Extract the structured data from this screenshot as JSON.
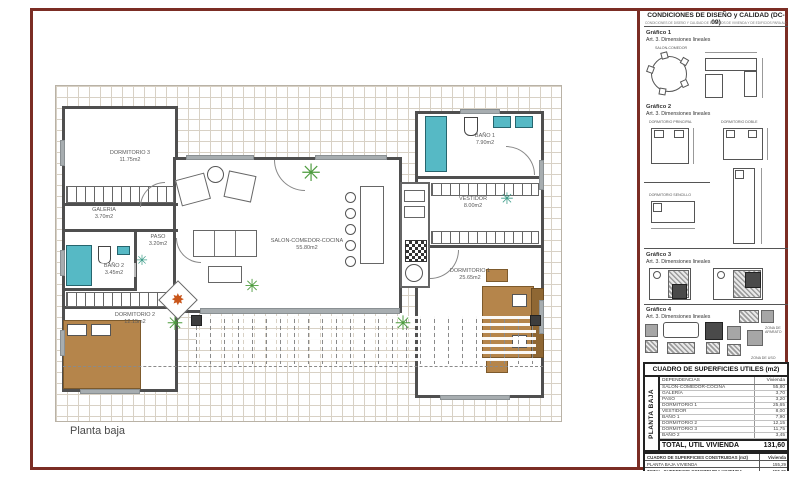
{
  "icons": {
    "plant": "✳",
    "compass_star": "✸"
  },
  "colors": {
    "frame": "#7b2d24",
    "wall": "#4f4f4f",
    "fixture_teal": "#56b9c5",
    "wood_tan": "#b5854b",
    "plant_green": "#4e9c3f",
    "accent_orange": "#c9561b"
  },
  "plan": {
    "floor_label": "Planta baja",
    "rooms": [
      {
        "name": "DORMITORIO 3",
        "area": "11.75m2"
      },
      {
        "name": "GALERIA",
        "area": "3.70m2"
      },
      {
        "name": "PASO",
        "area": "3.20m2"
      },
      {
        "name": "BAÑO 2",
        "area": "3.45m2"
      },
      {
        "name": "DORMITORIO 2",
        "area": "12.15m2"
      },
      {
        "name": "SALON-COMEDOR-COCINA",
        "area": "55.80m2"
      },
      {
        "name": "BAÑO 1",
        "area": "7.90m2"
      },
      {
        "name": "VESTIDOR",
        "area": "8.00m2"
      },
      {
        "name": "DORMITORIO 1",
        "area": "25.65m2"
      }
    ]
  },
  "panel": {
    "title": "CONDICIONES DE DISEÑO y CALIDAD (DC-09)",
    "subtitle": "CONDICIONES DE DISEÑO Y CALIDAD DE EDIFICIOS DE VIVIENDA Y DE EDIFICIOS PARA ALOJAMIENTO",
    "graficos": [
      {
        "label": "Gráfico 1",
        "art": "Art. 3. Dimensiones lineales",
        "caption": "SALON-COMEDOR"
      },
      {
        "label": "Gráfico 2",
        "art": "Art. 3. Dimensiones lineales",
        "caption_a": "DORMITORIO PRINCIPAL",
        "caption_b": "DORMITORIO DOBLE",
        "caption_c": "DORMITORIO SENCILLO"
      },
      {
        "label": "Gráfico 3",
        "art": "Art. 3. Dimensiones lineales"
      },
      {
        "label": "Gráfico 4",
        "art": "Art. 3. Dimensiones lineales",
        "zone_a": "ZONA DE APARATO",
        "zone_b": "ZONA DE USO"
      }
    ],
    "tables": {
      "utiles": {
        "title": "CUADRO DE SUPERFICIES UTILES (m2)",
        "side": "PLANTA BAJA",
        "col_label": "DEPENDENCIAS",
        "col_value": "Vivienda",
        "rows": [
          {
            "label": "SALON-COMEDOR-COCINA",
            "value": "55,80"
          },
          {
            "label": "GALERÍA",
            "value": "3,70"
          },
          {
            "label": "PASO",
            "value": "3,20"
          },
          {
            "label": "DORMITORIO 1",
            "value": "25,65"
          },
          {
            "label": "VESTIDOR",
            "value": "8,00"
          },
          {
            "label": "BAÑO 1",
            "value": "7,90"
          },
          {
            "label": "DORMITORIO 2",
            "value": "12,15"
          },
          {
            "label": "DORMITORIO 3",
            "value": "11,75"
          },
          {
            "label": "BAÑO 2",
            "value": "3,45"
          }
        ],
        "total_label": "TOTAL, ÚTIL VIVIENDA",
        "total_value": "131,60"
      },
      "construidas": {
        "title": "CUADRO DE SUPERFICIES CONSTRUIDAS (m2)",
        "col_value": "Vivienda",
        "rows": [
          {
            "label": "PLANTA BAJA VIVIENDA",
            "value": "155,29"
          },
          {
            "label": "TOTAL, SUPERFICIE CONSTRUIDA VIVIENDA",
            "value": "155,29"
          },
          {
            "label": "SUPERFICIE CONSTRUIDA",
            "value": ""
          }
        ]
      }
    }
  }
}
